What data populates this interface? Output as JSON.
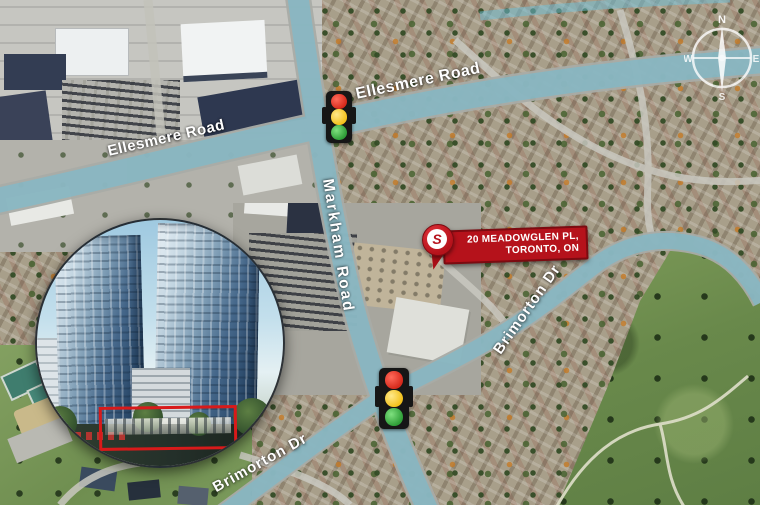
{
  "map": {
    "road_labels": {
      "ellesmere_left": "Ellesmere Road",
      "ellesmere_right": "Ellesmere Road",
      "markham": "Markham Road",
      "brimorton_right": "Brimorton Dr",
      "brimorton_left": "Brimorton Dr"
    },
    "marker": {
      "address_line1": "20 MEADOWGLEN PL,",
      "address_line2": "TORONTO, ON",
      "pin_letter": "S"
    },
    "compass": {
      "north": "N",
      "east": "E",
      "south": "S",
      "west": "W"
    },
    "colors": {
      "route_highlight": "#6fc0d8",
      "marker_red": "#b5121b",
      "highlight_box_red": "#d81a1a"
    }
  }
}
